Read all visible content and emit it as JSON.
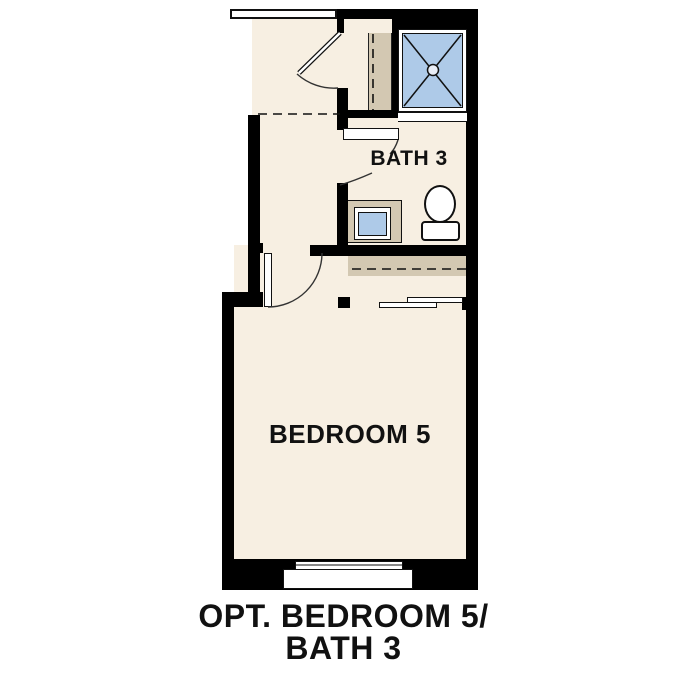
{
  "plan": {
    "rooms": {
      "bath3": {
        "label": "BATH 3"
      },
      "bedroom5": {
        "label": "BEDROOM 5"
      }
    },
    "caption": {
      "line1": "OPT. BEDROOM 5/",
      "line2": "BATH 3"
    },
    "fixtures": [
      "shower-pan",
      "shower-drain",
      "toilet",
      "sink-vanity",
      "closet-shelf-rod",
      "bypass-closet-doors",
      "window",
      "swing-doors"
    ],
    "colors": {
      "background": "#ffffff",
      "floor": "#f7efe2",
      "wall": "#000000",
      "cabinetry": "#d3c8b2",
      "water_fixture": "#aecae8",
      "text": "#111111"
    }
  }
}
